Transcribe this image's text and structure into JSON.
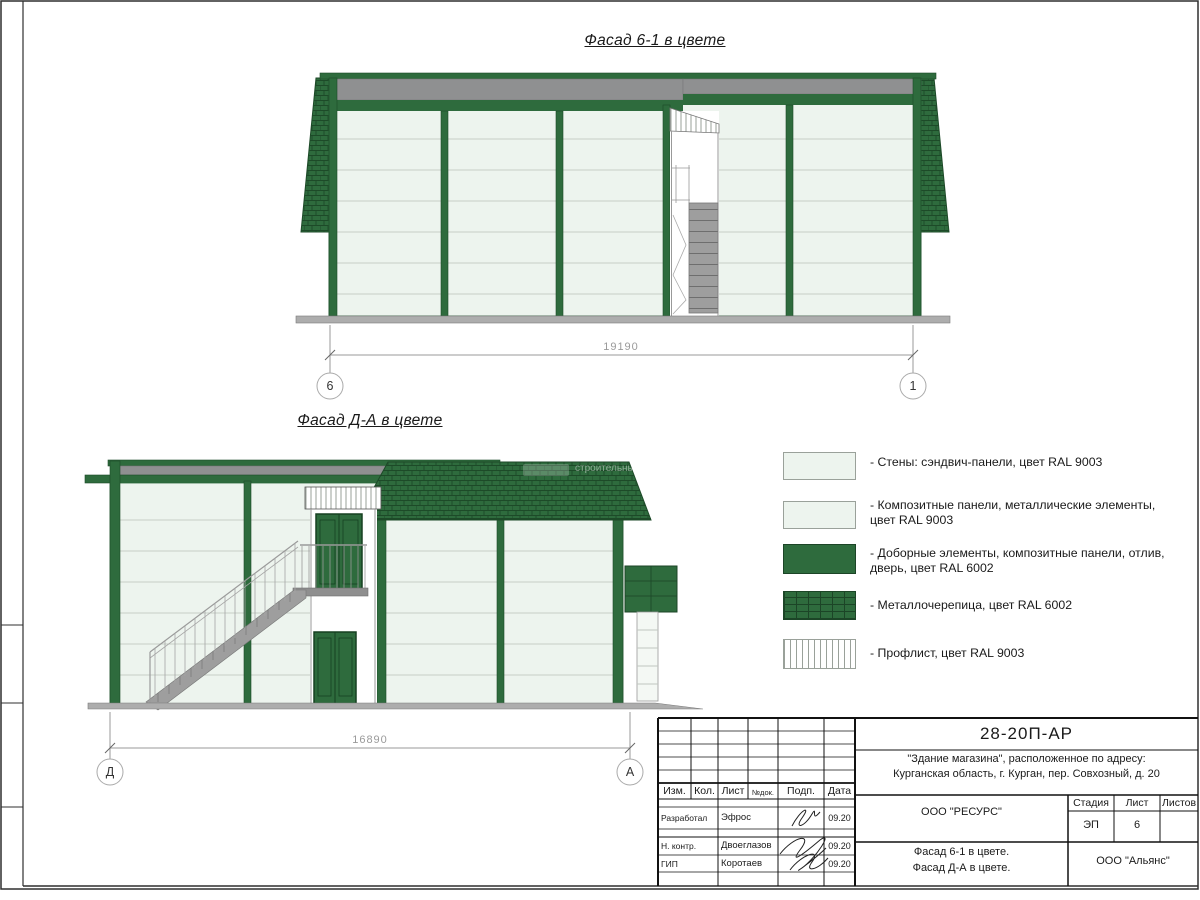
{
  "colors": {
    "green_ral6002": "#2e6b3d",
    "green_dark_line": "#1c4527",
    "panel_ral9003": "#edf4ee",
    "metal_gray": "#8f9091",
    "dim_gray": "#9a9a9a"
  },
  "facade1": {
    "title": "Фасад 6-1 в цвете",
    "dimension": "19190",
    "axis_left": "6",
    "axis_right": "1"
  },
  "facade2": {
    "title": "Фасад Д-А в цвете",
    "dimension": "16890",
    "axis_left": "Д",
    "axis_right": "А"
  },
  "watermark": "строительны",
  "legend": {
    "items": [
      {
        "name": "wall-sandwich-panels",
        "label": "- Стены: сэндвич-панели, цвет RAL 9003"
      },
      {
        "name": "composite-panels",
        "label": "- Композитные панели, металлические элементы, цвет RAL 9003"
      },
      {
        "name": "trim-elements",
        "label": "- Доборные элементы,  композитные панели, отлив, дверь, цвет RAL 6002"
      },
      {
        "name": "metal-tile",
        "label": "- Металлочерепица, цвет RAL 6002"
      },
      {
        "name": "profiled-sheet",
        "label": "- Профлист, цвет RAL 9003"
      }
    ]
  },
  "title_block": {
    "doc_code": "28-20П-АР",
    "project_line1": "\"Здание магазина\", расположенное по адресу:",
    "project_line2": "Курганская область, г. Курган, пер. Совхозный, д. 20",
    "col_izm": "Изм.",
    "col_kol": "Кол.",
    "col_list": "Лист",
    "col_ndok": "№док.",
    "col_podp": "Подп.",
    "col_data": "Дата",
    "row1_role": "Разработал",
    "row1_name": "Эфрос",
    "row1_date": "09.20",
    "row2_role": "Н. контр.",
    "row2_name": "Двоеглазов",
    "row2_date": "09.20",
    "row3_role": "ГИП",
    "row3_name": "Коротаев",
    "row3_date": "09.20",
    "org_designer": "ООО \"РЕСУРС\"",
    "stage_label": "Стадия",
    "list_label": "Лист",
    "listov_label": "Листов",
    "stage_value": "ЭП",
    "list_value": "6",
    "drawing_name_line1": "Фасад 6-1 в цвете.",
    "drawing_name_line2": "Фасад Д-А в цвете.",
    "org_client": "ООО \"Альянс\""
  }
}
